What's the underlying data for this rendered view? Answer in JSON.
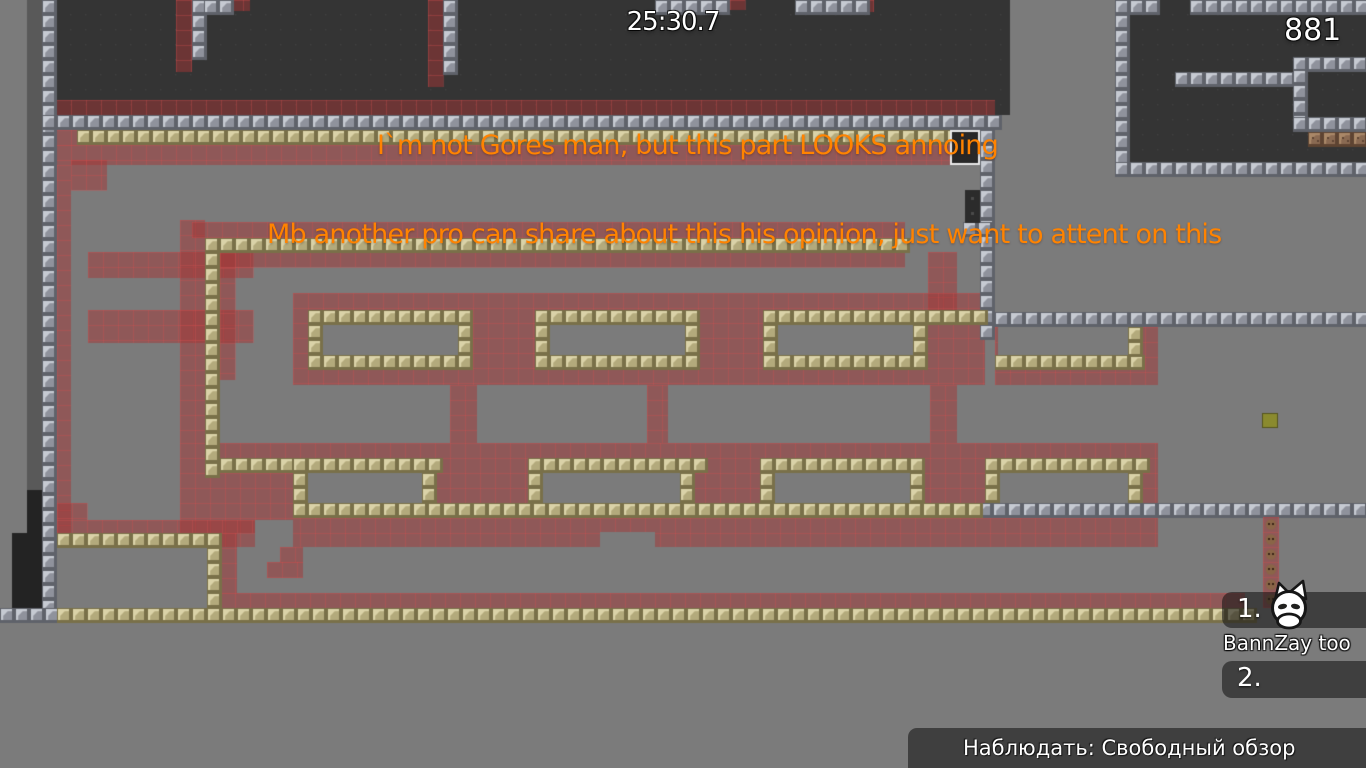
{
  "hud": {
    "timer": "25:30.7",
    "score": "881"
  },
  "broadcast": {
    "line1": "I`m not Gores man, but this part LOOKS annoing",
    "line2": "Mb another pro can share about this his opinion, just want to attent on this",
    "color": "#ff8300"
  },
  "spectator_panel": {
    "rank1": "1.",
    "player1": "BannZay too",
    "rank2": "2."
  },
  "status_bar": {
    "label": "Наблюдать: Свободный обзор"
  },
  "colors": {
    "background": "#7b7b7b",
    "dark_room": "#343434",
    "dark_strip": "#595959",
    "black_block": "#232323",
    "room_dot": "#414141",
    "unhook_base": "#8f929c",
    "unhook_light": "#c6cad2",
    "unhook_dark": "#5f626a",
    "hook_base": "#b3aa7c",
    "hook_light": "#dad3a8",
    "hook_dark": "#797049",
    "brown_base": "#8a6a52",
    "brown_dark": "#5e4432",
    "freeze_fill": "rgba(163,53,53,0.50)",
    "freeze_grid": "rgba(210,80,80,0.35)",
    "olive": "#8a8a2e",
    "coin": "#8a6547",
    "coin_dot": "#3a2517",
    "panel_bg": "rgba(20,20,20,0.58)",
    "hud_white": "#ffffff"
  },
  "map": {
    "tile": 15,
    "rects": [
      [
        "dk",
        27,
        0,
        15,
        490
      ],
      [
        "bk",
        27,
        490,
        15,
        120
      ],
      [
        "bk",
        12,
        533,
        15,
        77
      ],
      [
        "rm",
        56,
        0,
        954,
        115
      ],
      [
        "rm",
        1128,
        0,
        238,
        162
      ],
      [
        "f",
        176,
        0,
        16,
        72
      ],
      [
        "f",
        228,
        0,
        22,
        11
      ],
      [
        "f",
        428,
        0,
        15,
        87
      ],
      [
        "f",
        730,
        0,
        15,
        10
      ],
      [
        "f",
        858,
        0,
        16,
        12
      ],
      [
        "f",
        56,
        100,
        939,
        15
      ],
      [
        "f",
        56,
        130,
        21,
        15
      ],
      [
        "f",
        56,
        145,
        934,
        20
      ],
      [
        "f",
        57,
        165,
        14,
        368
      ],
      [
        "f",
        71,
        160,
        36,
        30
      ],
      [
        "f",
        88,
        252,
        165,
        26
      ],
      [
        "f",
        88,
        310,
        165,
        33
      ],
      [
        "f",
        180,
        220,
        25,
        223
      ],
      [
        "f",
        220,
        238,
        15,
        142
      ],
      [
        "f",
        192,
        222,
        713,
        16
      ],
      [
        "f",
        205,
        252,
        700,
        15
      ],
      [
        "f",
        928,
        252,
        29,
        58
      ],
      [
        "f",
        293,
        293,
        692,
        92
      ],
      [
        "f",
        995,
        327,
        163,
        58
      ],
      [
        "f",
        450,
        385,
        27,
        58
      ],
      [
        "f",
        647,
        385,
        21,
        58
      ],
      [
        "f",
        930,
        385,
        27,
        58
      ],
      [
        "f",
        180,
        443,
        978,
        104
      ],
      [
        "f",
        57,
        503,
        30,
        17
      ],
      [
        "f",
        57,
        520,
        210,
        13
      ],
      [
        "f",
        220,
        533,
        17,
        60
      ],
      [
        "f",
        280,
        547,
        23,
        15
      ],
      [
        "f",
        267,
        562,
        36,
        16
      ],
      [
        "f",
        220,
        593,
        1025,
        15
      ],
      [
        "g",
        323,
        325,
        135,
        30
      ],
      [
        "g",
        550,
        325,
        135,
        30
      ],
      [
        "g",
        778,
        325,
        135,
        30
      ],
      [
        "g",
        998,
        327,
        130,
        28
      ],
      [
        "g",
        308,
        473,
        114,
        30
      ],
      [
        "g",
        543,
        473,
        137,
        30
      ],
      [
        "g",
        775,
        473,
        135,
        30
      ],
      [
        "g",
        1000,
        473,
        128,
        30
      ],
      [
        "g",
        255,
        520,
        38,
        27
      ],
      [
        "g",
        600,
        532,
        55,
        15
      ],
      [
        "u",
        42,
        0,
        15,
        608
      ],
      [
        "u",
        0,
        608,
        57,
        15
      ],
      [
        "u",
        192,
        0,
        12,
        54
      ],
      [
        "u",
        204,
        0,
        24,
        11
      ],
      [
        "u",
        655,
        0,
        75,
        10
      ],
      [
        "u",
        795,
        0,
        63,
        12
      ],
      [
        "u",
        443,
        0,
        15,
        70
      ],
      [
        "u",
        42,
        115,
        953,
        15
      ],
      [
        "u",
        980,
        130,
        15,
        197
      ],
      [
        "u",
        995,
        312,
        371,
        15
      ],
      [
        "u",
        963,
        222,
        17,
        15
      ],
      [
        "u",
        978,
        503,
        388,
        15
      ],
      [
        "u",
        1115,
        0,
        13,
        162
      ],
      [
        "u",
        1115,
        0,
        45,
        8
      ],
      [
        "u",
        1190,
        0,
        176,
        8
      ],
      [
        "u",
        1115,
        162,
        251,
        15
      ],
      [
        "u",
        1175,
        72,
        118,
        13
      ],
      [
        "u",
        1293,
        57,
        73,
        13
      ],
      [
        "u",
        1293,
        70,
        14,
        60
      ],
      [
        "u",
        1293,
        117,
        73,
        13
      ],
      [
        "h",
        57,
        608,
        1190,
        15
      ],
      [
        "h",
        77,
        130,
        898,
        15
      ],
      [
        "h",
        205,
        238,
        700,
        15
      ],
      [
        "h",
        205,
        238,
        15,
        235
      ],
      [
        "h",
        928,
        310,
        52,
        15
      ],
      [
        "h",
        308,
        310,
        165,
        15
      ],
      [
        "h",
        308,
        355,
        165,
        15
      ],
      [
        "h",
        308,
        325,
        15,
        30
      ],
      [
        "h",
        458,
        325,
        15,
        30
      ],
      [
        "h",
        535,
        310,
        165,
        15
      ],
      [
        "h",
        535,
        355,
        165,
        15
      ],
      [
        "h",
        535,
        325,
        15,
        30
      ],
      [
        "h",
        685,
        325,
        15,
        30
      ],
      [
        "h",
        763,
        310,
        165,
        15
      ],
      [
        "h",
        763,
        355,
        165,
        15
      ],
      [
        "h",
        763,
        325,
        15,
        30
      ],
      [
        "h",
        913,
        325,
        15,
        30
      ],
      [
        "h",
        995,
        355,
        148,
        15
      ],
      [
        "h",
        1128,
        327,
        15,
        28
      ],
      [
        "h",
        220,
        458,
        73,
        15
      ],
      [
        "h",
        293,
        458,
        144,
        15
      ],
      [
        "h",
        293,
        473,
        15,
        30
      ],
      [
        "h",
        422,
        473,
        15,
        30
      ],
      [
        "h",
        528,
        458,
        167,
        15
      ],
      [
        "h",
        528,
        473,
        15,
        30
      ],
      [
        "h",
        680,
        473,
        15,
        30
      ],
      [
        "h",
        760,
        458,
        165,
        15
      ],
      [
        "h",
        760,
        473,
        15,
        30
      ],
      [
        "h",
        910,
        473,
        15,
        30
      ],
      [
        "h",
        985,
        458,
        158,
        15
      ],
      [
        "h",
        985,
        473,
        15,
        30
      ],
      [
        "h",
        1128,
        473,
        15,
        30
      ],
      [
        "h",
        293,
        503,
        685,
        15
      ],
      [
        "h",
        57,
        533,
        163,
        15
      ],
      [
        "h",
        207,
        533,
        15,
        75
      ],
      [
        "b",
        1308,
        132,
        58,
        15
      ],
      [
        "c",
        1263,
        517,
        16,
        91
      ],
      [
        "o",
        965,
        130,
        15,
        17
      ],
      [
        "o",
        1262,
        413,
        16,
        15
      ],
      [
        "wb",
        950,
        130,
        30,
        35
      ],
      [
        "dt",
        965,
        190,
        15,
        33
      ]
    ]
  }
}
